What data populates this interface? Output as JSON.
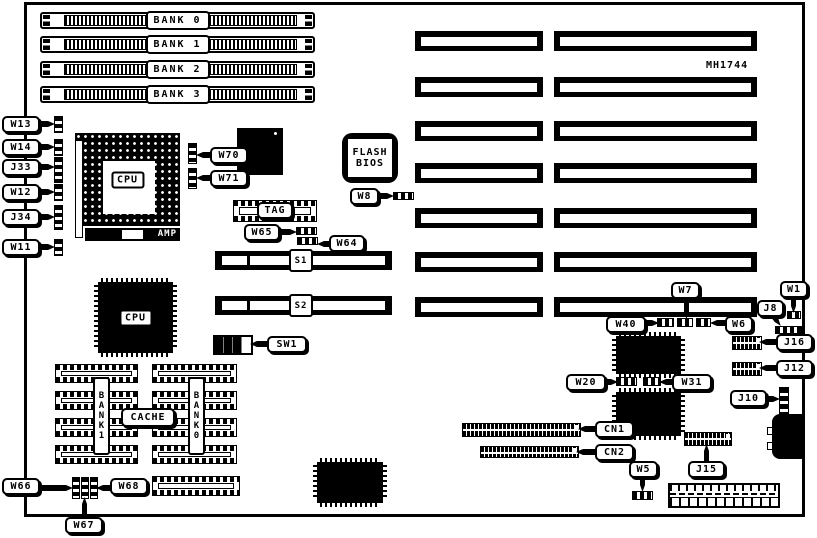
{
  "board": {
    "model": "MH1744"
  },
  "memory_banks": [
    "BANK 0",
    "BANK 1",
    "BANK 2",
    "BANK 3"
  ],
  "chips": {
    "cpu_socket": "CPU",
    "cpu_socket_brand": "AMP",
    "cpu_chip": "CPU",
    "flash_bios_line1": "FLASH",
    "flash_bios_line2": "BIOS",
    "tag_socket": "TAG",
    "cache_label": "CACHE",
    "cache_bank1": "BANK1",
    "cache_bank0": "BANK0"
  },
  "slots": {
    "s1": "S1",
    "s2": "S2"
  },
  "labels": {
    "w13": "W13",
    "w14": "W14",
    "j33": "J33",
    "w12": "W12",
    "j34": "J34",
    "w11": "W11",
    "w70": "W70",
    "w71": "W71",
    "w8": "W8",
    "w65": "W65",
    "w64": "W64",
    "sw1": "SW1",
    "w66": "W66",
    "w67": "W67",
    "w68": "W68",
    "w1": "W1",
    "j8": "J8",
    "w7": "W7",
    "w40": "W40",
    "w6": "W6",
    "j16": "J16",
    "j12": "J12",
    "j10": "J10",
    "w20": "W20",
    "w31": "W31",
    "cn1": "CN1",
    "cn2": "CN2",
    "w5": "W5",
    "j15": "J15"
  }
}
